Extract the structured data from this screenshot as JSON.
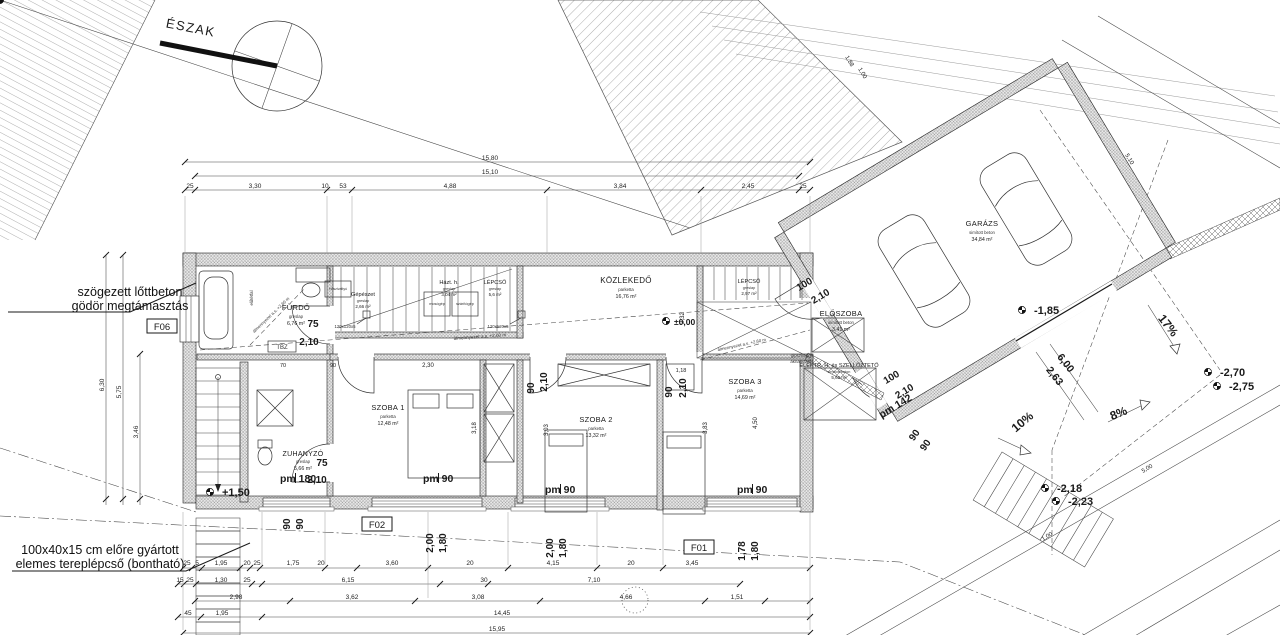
{
  "north": {
    "label": "ÉSZAK"
  },
  "notes": {
    "pit1": "szögezett lőttbeton",
    "pit2": "gödör megtámasztás",
    "steps1": "100x40x15 cm előre gyártott",
    "steps2": "elemes tereplépcső (bontható)"
  },
  "frames": {
    "f06": "F06",
    "f02": "F02",
    "f01": "F01"
  },
  "rooms": [
    {
      "name": "FÜRDŐ",
      "finish": "greslap",
      "area": "6,76 m²"
    },
    {
      "name": "Gépészet",
      "finish": "greslap",
      "area": "2,66 m²"
    },
    {
      "name": "Házt. h.",
      "finish": "greslap",
      "area": "3,04 m²"
    },
    {
      "name": "LÉPCSŐ",
      "finish": "greslap",
      "area": "5,6 m²"
    },
    {
      "name": "KÖZLEKEDŐ",
      "finish": "parketta",
      "area": "16,76 m²"
    },
    {
      "name": "LÉPCSŐ",
      "finish": "greslap",
      "area": "2,97 m²"
    },
    {
      "name": "ELŐSZOBA",
      "finish": "simított beton",
      "area": "3,41 m²"
    },
    {
      "name": "ELEKTR. H. és SZELLŐZTETŐ",
      "finish": "simított beton",
      "area": "5,62 m²"
    },
    {
      "name": "GARÁZS",
      "finish": "simított beton",
      "area": "34,84 m²"
    },
    {
      "name": "ZUHANYZÓ",
      "finish": "greslap",
      "area": "5,66 m²"
    },
    {
      "name": "SZOBA 1",
      "finish": "parketta",
      "area": "12,48 m²"
    },
    {
      "name": "SZOBA 2",
      "finish": "parketta",
      "area": "13,32 m²"
    },
    {
      "name": "SZOBA 3",
      "finish": "parketta",
      "area": "14,69 m²"
    }
  ],
  "levels": {
    "entry": "+1,50",
    "ground": "±0,00",
    "garage_front": "-1,85",
    "drive_a": "-2,70",
    "drive_b": "-2,75",
    "yard_a": "-2,18",
    "yard_b": "-2,23"
  },
  "slopes": {
    "r17": "17%",
    "r10": "10%",
    "r8": "8%",
    "len_a": "6,00",
    "len_b": "2,63"
  },
  "sills": {
    "s180": "pm 180",
    "s90a": "pm 90",
    "s90b": "pm 90",
    "s90c": "pm 90",
    "s142": "pm 142"
  },
  "equip": {
    "heatpump": "Hőszivattyú",
    "washer": "mosógép",
    "dryer": "szárítógép",
    "tbz": "TBZ",
    "column": "120x120x5",
    "liner": "előtétfal"
  },
  "ceiling": {
    "a": "álmennyezet a.s. +2,60 m",
    "b": "gipszkarton",
    "c": "aknalezárás"
  },
  "dim_labels": [
    {
      "t": "15,80",
      "x": 490,
      "y": 160
    },
    {
      "t": "15,10",
      "x": 490,
      "y": 174
    },
    {
      "t": "25",
      "x": 190,
      "y": 188
    },
    {
      "t": "3,30",
      "x": 255,
      "y": 188
    },
    {
      "t": "10",
      "x": 325,
      "y": 188
    },
    {
      "t": "53",
      "x": 343,
      "y": 188
    },
    {
      "t": "4,88",
      "x": 450,
      "y": 188
    },
    {
      "t": "3,84",
      "x": 620,
      "y": 188
    },
    {
      "t": "2,45",
      "x": 748,
      "y": 188
    },
    {
      "t": "25",
      "x": 803,
      "y": 188
    },
    {
      "t": "6,30",
      "x": 104,
      "y": 385,
      "r": -90
    },
    {
      "t": "5,75",
      "x": 121,
      "y": 392,
      "r": -90
    },
    {
      "t": "3,46",
      "x": 138,
      "y": 432,
      "r": -90
    },
    {
      "t": "25",
      "x": 187,
      "y": 565
    },
    {
      "t": "5",
      "x": 197,
      "y": 565
    },
    {
      "t": "1,95",
      "x": 221,
      "y": 565
    },
    {
      "t": "20",
      "x": 247,
      "y": 565
    },
    {
      "t": "25",
      "x": 257,
      "y": 565
    },
    {
      "t": "1,75",
      "x": 293,
      "y": 565
    },
    {
      "t": "20",
      "x": 321,
      "y": 565
    },
    {
      "t": "3,60",
      "x": 392,
      "y": 565
    },
    {
      "t": "20",
      "x": 470,
      "y": 565
    },
    {
      "t": "4,15",
      "x": 553,
      "y": 565
    },
    {
      "t": "20",
      "x": 631,
      "y": 565
    },
    {
      "t": "3,45",
      "x": 692,
      "y": 565
    },
    {
      "t": "15",
      "x": 180,
      "y": 582
    },
    {
      "t": "25",
      "x": 190,
      "y": 582
    },
    {
      "t": "1,30",
      "x": 221,
      "y": 582
    },
    {
      "t": "25",
      "x": 247,
      "y": 582
    },
    {
      "t": "6,15",
      "x": 348,
      "y": 582
    },
    {
      "t": "30",
      "x": 484,
      "y": 582
    },
    {
      "t": "7,10",
      "x": 594,
      "y": 582
    },
    {
      "t": "2,98",
      "x": 236,
      "y": 599
    },
    {
      "t": "3,62",
      "x": 352,
      "y": 599
    },
    {
      "t": "3,08",
      "x": 478,
      "y": 599
    },
    {
      "t": "4,66",
      "x": 626,
      "y": 599
    },
    {
      "t": "1,51",
      "x": 737,
      "y": 599
    },
    {
      "t": "45",
      "x": 188,
      "y": 615
    },
    {
      "t": "1,95",
      "x": 222,
      "y": 615
    },
    {
      "t": "14,45",
      "x": 502,
      "y": 615
    },
    {
      "t": "15,95",
      "x": 497,
      "y": 631
    },
    {
      "t": "70",
      "x": 283,
      "y": 367,
      "s": 5.5
    },
    {
      "t": "90",
      "x": 333,
      "y": 367,
      "s": 5.5
    },
    {
      "t": "2,30",
      "x": 428,
      "y": 367,
      "s": 6
    },
    {
      "t": "1,18",
      "x": 681,
      "y": 372,
      "s": 5.5
    },
    {
      "t": "3,18",
      "x": 476,
      "y": 428,
      "r": -90,
      "s": 6
    },
    {
      "t": "3,03",
      "x": 548,
      "y": 430,
      "r": -90,
      "s": 6
    },
    {
      "t": "3,83",
      "x": 707,
      "y": 428,
      "r": -90,
      "s": 6
    },
    {
      "t": "4,50",
      "x": 757,
      "y": 423,
      "r": -90,
      "s": 6
    },
    {
      "t": "2,32",
      "x": 684,
      "y": 318,
      "r": -90,
      "s": 6
    },
    {
      "t": "1,88",
      "x": 848,
      "y": 62,
      "r": 59,
      "s": 6
    },
    {
      "t": "1,00",
      "x": 861,
      "y": 74,
      "r": 59,
      "s": 6
    },
    {
      "t": "5,10",
      "x": 1128,
      "y": 160,
      "r": 59,
      "s": 6
    },
    {
      "t": "5,00",
      "x": 1148,
      "y": 470,
      "r": -31,
      "s": 6
    },
    {
      "t": "1,00",
      "x": 1048,
      "y": 538,
      "r": -31,
      "s": 6
    },
    {
      "t": "75",
      "x": 313,
      "y": 327,
      "b": 1
    },
    {
      "t": "2,10",
      "x": 309,
      "y": 345,
      "b": 1
    },
    {
      "t": "75",
      "x": 322,
      "y": 466,
      "b": 1
    },
    {
      "t": "2,10",
      "x": 317,
      "y": 483,
      "b": 1
    },
    {
      "t": "90",
      "x": 534,
      "y": 388,
      "r": -90,
      "b": 1
    },
    {
      "t": "2,10",
      "x": 547,
      "y": 382,
      "r": -90,
      "b": 1
    },
    {
      "t": "90",
      "x": 672,
      "y": 392,
      "r": -90,
      "b": 1
    },
    {
      "t": "2,10",
      "x": 686,
      "y": 388,
      "r": -90,
      "b": 1
    },
    {
      "t": "100",
      "x": 806,
      "y": 287,
      "r": -31,
      "b": 1
    },
    {
      "t": "2,10",
      "x": 822,
      "y": 299,
      "r": -31,
      "b": 1
    },
    {
      "t": "100",
      "x": 893,
      "y": 380,
      "r": -31,
      "b": 1
    },
    {
      "t": "2,10",
      "x": 906,
      "y": 394,
      "r": -31,
      "b": 1
    },
    {
      "t": "90",
      "x": 917,
      "y": 437,
      "r": -55,
      "b": 1
    },
    {
      "t": "90",
      "x": 928,
      "y": 447,
      "r": -55,
      "b": 1
    },
    {
      "t": "90",
      "x": 290,
      "y": 524,
      "r": -90,
      "b": 1
    },
    {
      "t": "90",
      "x": 303,
      "y": 524,
      "r": -90,
      "b": 1
    },
    {
      "t": "2,00",
      "x": 433,
      "y": 543,
      "r": -90,
      "b": 1
    },
    {
      "t": "1,80",
      "x": 446,
      "y": 543,
      "r": -90,
      "b": 1
    },
    {
      "t": "2,00",
      "x": 553,
      "y": 548,
      "r": -90,
      "b": 1
    },
    {
      "t": "1,80",
      "x": 566,
      "y": 548,
      "r": -90,
      "b": 1
    },
    {
      "t": "1,78",
      "x": 745,
      "y": 551,
      "r": -90,
      "b": 1
    },
    {
      "t": "1,80",
      "x": 758,
      "y": 551,
      "r": -90,
      "b": 1
    }
  ]
}
